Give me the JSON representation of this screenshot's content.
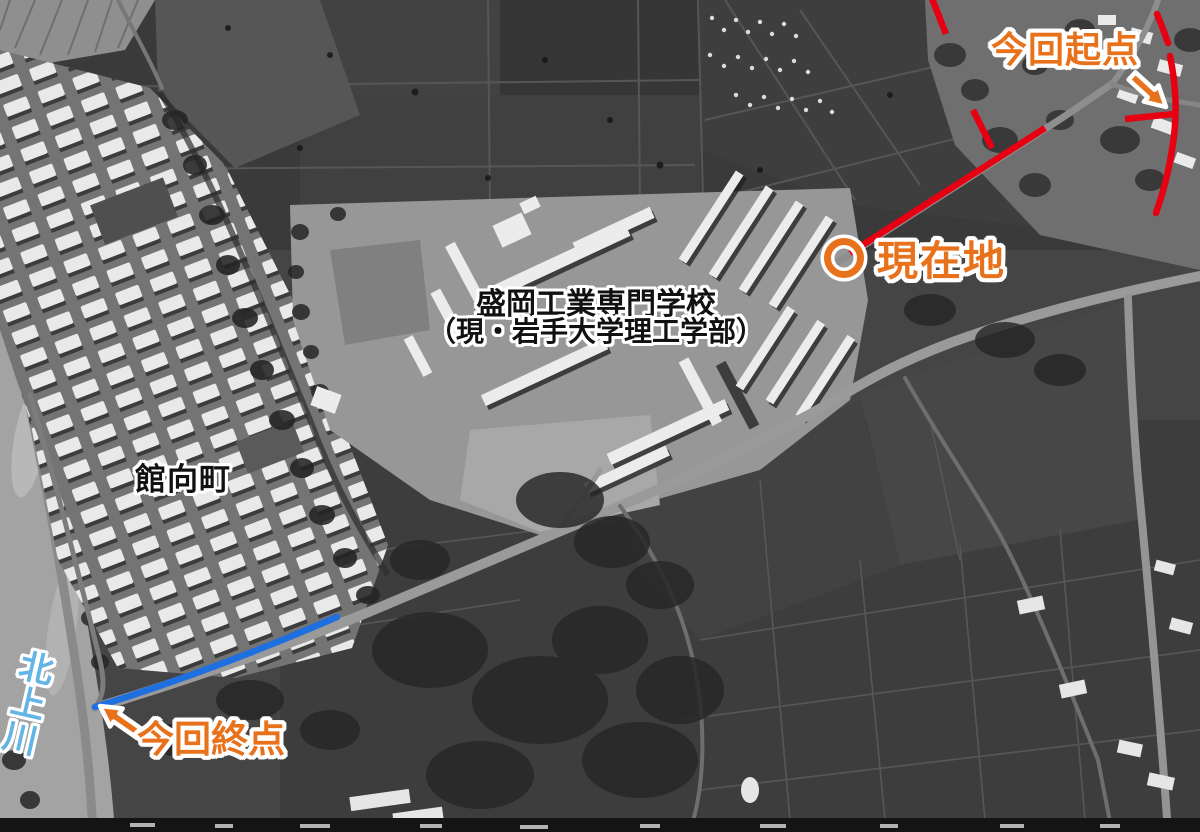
{
  "annotations": {
    "start": {
      "label": "今回起点"
    },
    "current": {
      "label": "現在地"
    },
    "school": {
      "line1": "盛岡工業専門学校",
      "line2": "（現・岩手大学理工学部）"
    },
    "town": {
      "label": "館向町"
    },
    "river": {
      "label": "北上川"
    },
    "end": {
      "label": "今回終点"
    }
  },
  "colors": {
    "annotation_orange": "#e8721c",
    "route_red": "#e60012",
    "route_blue": "#1e6fe0",
    "river_label_blue": "#63b5e6",
    "map_label_black": "#111111",
    "outline_white": "#ffffff"
  }
}
